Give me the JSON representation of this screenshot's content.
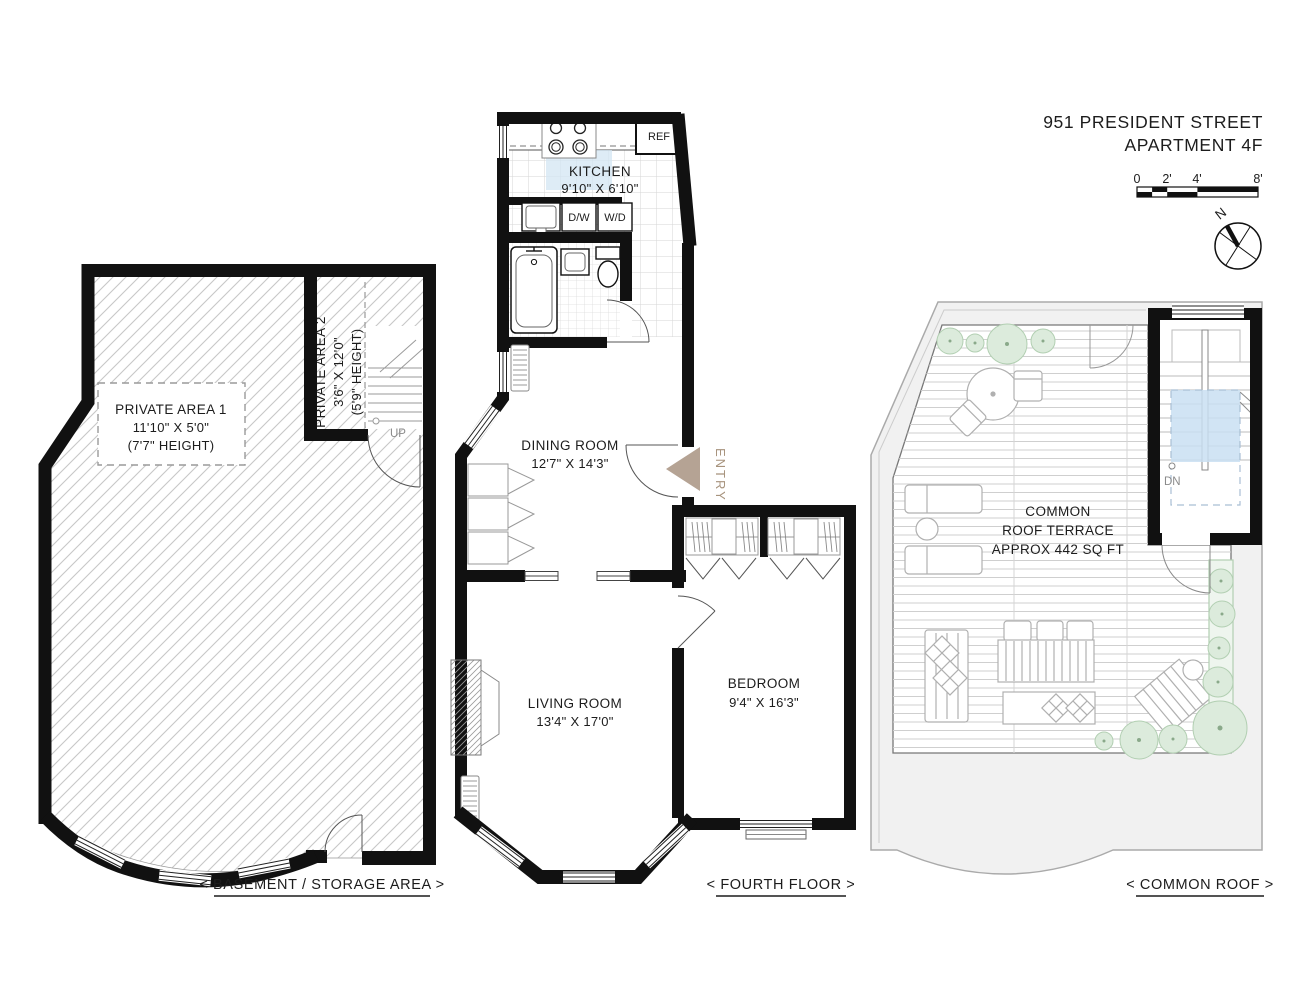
{
  "header": {
    "title_line1": "951 PRESIDENT STREET",
    "title_line2": "APARTMENT 4F"
  },
  "scale_bar": {
    "ticks": [
      "0",
      "2'",
      "4'",
      "8'"
    ]
  },
  "compass": {
    "north_label": "N"
  },
  "basement": {
    "floor_label": "< BASEMENT / STORAGE AREA >",
    "private_area_1": {
      "name": "PRIVATE AREA 1",
      "dimensions": "11'10\" X 5'0\"",
      "height": "(7'7\" HEIGHT)"
    },
    "private_area_2": {
      "name": "PRIVATE AREA 2",
      "dimensions": "3'6\" X 12'0\"",
      "height": "(5'9\" HEIGHT)"
    },
    "stair_label": "UP"
  },
  "fourth_floor": {
    "floor_label": "< FOURTH FLOOR >",
    "kitchen": {
      "name": "KITCHEN",
      "dimensions": "9'10\" X 6'10\""
    },
    "dining_room": {
      "name": "DINING ROOM",
      "dimensions": "12'7\" X 14'3\""
    },
    "living_room": {
      "name": "LIVING ROOM",
      "dimensions": "13'4\" X 17'0\""
    },
    "bedroom": {
      "name": "BEDROOM",
      "dimensions": "9'4\" X 16'3\""
    },
    "appliances": {
      "refrigerator": "REF",
      "dishwasher": "D/W",
      "washer_dryer": "W/D"
    },
    "entry_label": "ENTRY"
  },
  "roof": {
    "floor_label": "< COMMON ROOF >",
    "terrace_line1": "COMMON",
    "terrace_line2": "ROOF TERRACE",
    "terrace_line3": "APPROX 442 SQ FT",
    "stair_label": "DN"
  },
  "colors": {
    "wall": "#111111",
    "entry_arrow": "#b5a394",
    "skylight_blue": "#c9dff2",
    "kitchen_highlight": "#d3e6f3",
    "plant_green": "#dcebdc"
  }
}
